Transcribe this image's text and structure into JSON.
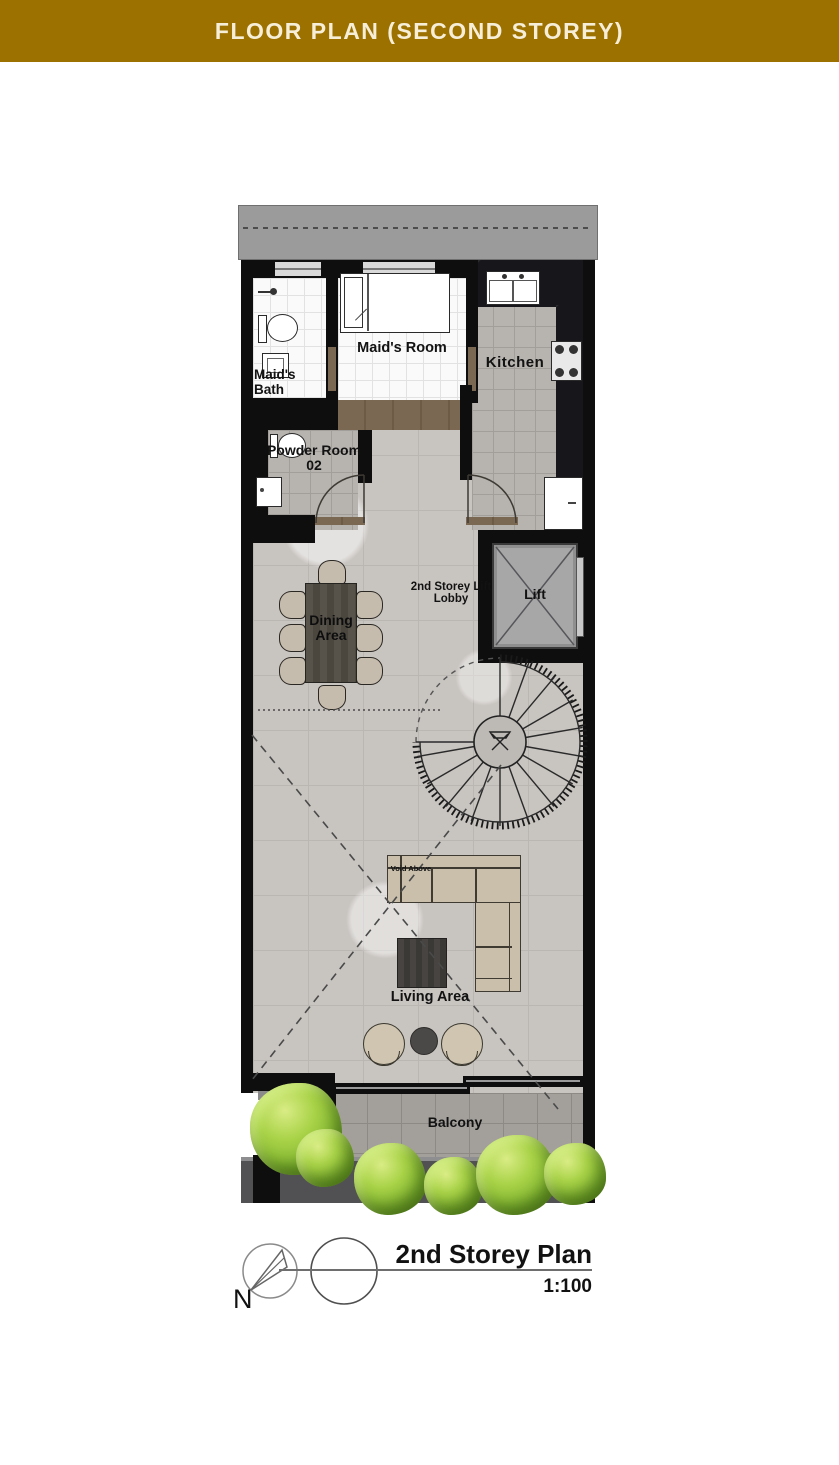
{
  "header": {
    "title": "FLOOR PLAN (SECOND STOREY)"
  },
  "plan": {
    "rooms": {
      "maids_bath": "Maid's Bath",
      "maids_room": "Maid's Room",
      "kitchen": "Kitchen",
      "powder_room": "Powder Room 02",
      "lift_lobby": "2nd Storey Lift Lobby",
      "lift": "Lift",
      "dining_area": "Dining Area",
      "living_area": "Living Area",
      "balcony": "Balcony"
    },
    "notes": {
      "void_above": "Void Above"
    }
  },
  "footer": {
    "plan_title": "2nd Storey Plan",
    "scale": "1:100",
    "north_label": "N"
  },
  "colors": {
    "banner_gold": "#9c7100",
    "banner_text": "#f6eed6",
    "wall_black": "#0e0e0f",
    "floor_gray": "#c8c4c0",
    "bush_green": "#8fc43c",
    "wood_brown": "#75624d"
  }
}
